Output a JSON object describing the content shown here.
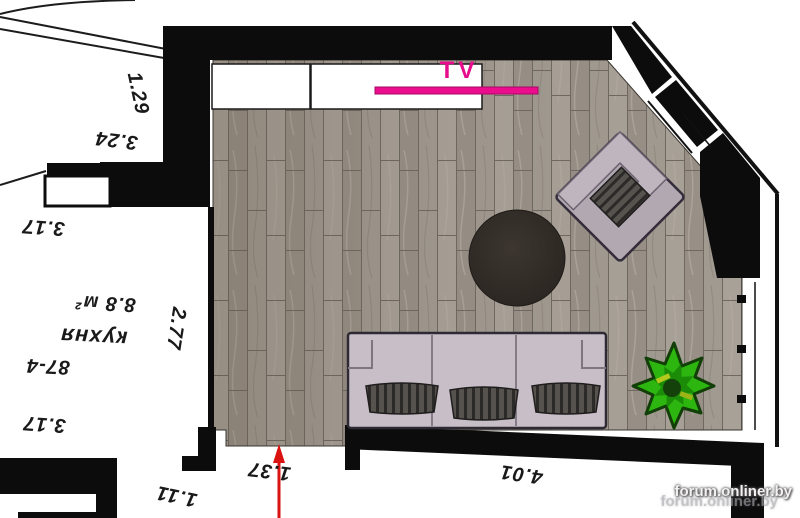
{
  "plan": {
    "tv_label": "TV",
    "kitchen": {
      "name": "кухня",
      "unit_no": "87-4",
      "area": "8.8 м²"
    },
    "dimensions": {
      "d_129": "1.29",
      "d_324": "3.24",
      "d_317_top": "3.17",
      "d_317_bottom": "3.17",
      "d_277": "2.77",
      "d_111": "1.11",
      "d_137": "1.37",
      "d_401": "4.01"
    },
    "colors": {
      "tv_accent": "#ec0c8e",
      "arrow_red": "#da1210",
      "plant_green": "#2cb60f",
      "wall_black": "#0d0c0d",
      "floor_base": "#a19a91",
      "sofa": "#c7bec8"
    }
  },
  "watermark": {
    "text": "forum.onliner.by",
    "ghost": "forum.onliner.by"
  }
}
